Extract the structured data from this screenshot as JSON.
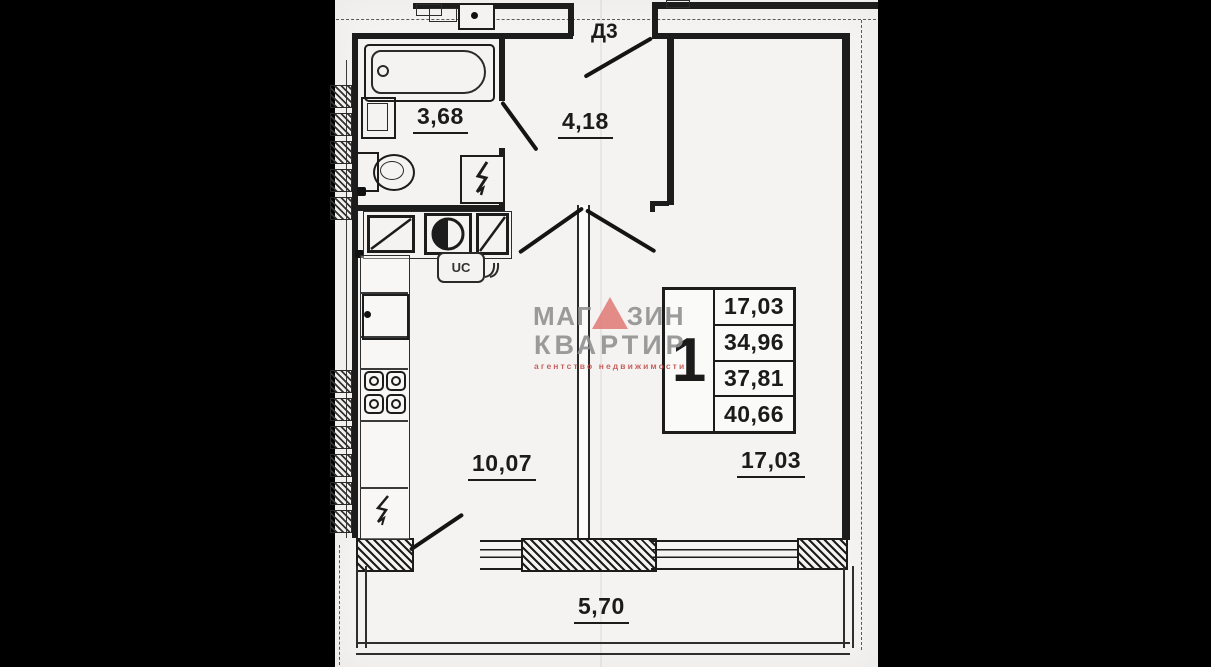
{
  "labels": {
    "door": "Д3",
    "bathroom_area": "3,68",
    "hallway_area": "4,18",
    "kitchen_area": "10,07",
    "living_room_area": "17,03",
    "balcony_length": "5,70",
    "utility_box": "UC"
  },
  "area_table": {
    "unit_number": "1",
    "values": [
      "17,03",
      "34,96",
      "37,81",
      "40,66"
    ]
  },
  "watermark": {
    "word1_prefix": "МАГ",
    "word1_suffix": "ЗИН",
    "word2": "КВАРТИР",
    "tagline": "агентство недвижимости",
    "text_color": "#919191",
    "triangle_color": "#e2807c",
    "tagline_color": "#c4524e"
  },
  "equipment_icons": [
    "bathtub-icon",
    "washbasin-icon",
    "toilet-icon",
    "water-heater-lightning-icon",
    "washing-machine-icon",
    "round-sink-icon",
    "dishwasher-icon",
    "kitchen-sink-icon",
    "stove-icon",
    "fridge-lightning-icon",
    "vent-shaft-icon"
  ],
  "colors": {
    "paper": "#f4f3f1",
    "ink": "#1c1c1c",
    "letterbox": "#000000"
  }
}
